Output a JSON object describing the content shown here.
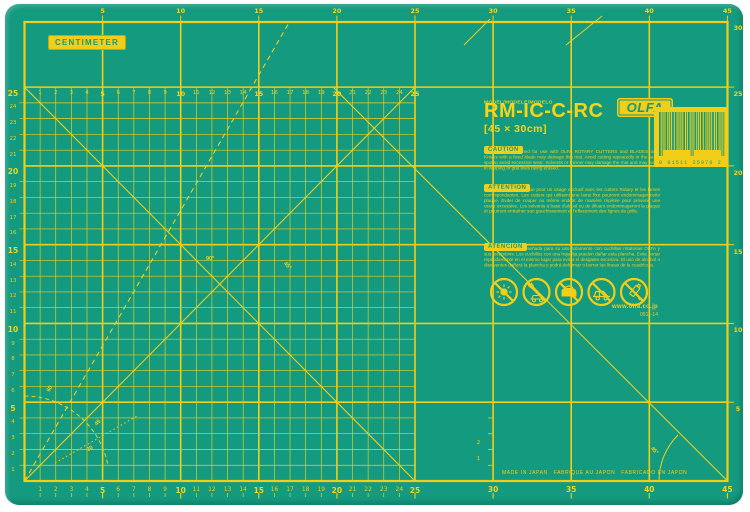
{
  "colors": {
    "mat_green": "#149A7F",
    "grid_yellow": "#F2CE18",
    "bright_yellow": "#F7D516",
    "page_white": "#FFFFFF"
  },
  "unit_tag": "CENTIMETER",
  "rulers": {
    "top": [
      "5",
      "10",
      "15",
      "20",
      "25",
      "30",
      "35",
      "40",
      "45"
    ],
    "grid_top": [
      "1",
      "2",
      "3",
      "4",
      "5",
      "6",
      "7",
      "8",
      "9",
      "10",
      "11",
      "12",
      "13",
      "14",
      "15",
      "16",
      "17",
      "18",
      "19",
      "20",
      "21",
      "22",
      "23",
      "24",
      "25"
    ],
    "bottom": [
      "1",
      "2",
      "3",
      "4",
      "5",
      "6",
      "7",
      "8",
      "9",
      "10",
      "11",
      "12",
      "13",
      "14",
      "15",
      "16",
      "17",
      "18",
      "19",
      "20",
      "21",
      "22",
      "23",
      "24",
      "25"
    ],
    "bottom_coarse": [
      "30",
      "35",
      "40",
      "45"
    ],
    "left": [
      "1",
      "2",
      "3",
      "4",
      "5",
      "6",
      "7",
      "8",
      "9",
      "10",
      "11",
      "12",
      "13",
      "14",
      "15",
      "16",
      "17",
      "18",
      "19",
      "20",
      "21",
      "22",
      "23",
      "24",
      "25"
    ],
    "right": [
      "30",
      "25",
      "20",
      "15",
      "10",
      "5"
    ],
    "mini": [
      "2",
      "1"
    ]
  },
  "angle_labels": {
    "a60": "60",
    "a45": "45",
    "a30": "30",
    "a90": "90°",
    "mid45": "45°",
    "br45": "45°"
  },
  "label": {
    "model_caption": "MODEL/MODELE/MODELO",
    "model": "RM-IC-C-RC",
    "size": "[45 × 30cm]",
    "brand": "OLFA",
    "brand_reg": "®",
    "sections": [
      {
        "heading": "CAUTION",
        "body": "This mat is designed for use with OLFA ROTARY CUTTERS and BLADES only. Knives with a fixed blade may damage this mat. Avoid cutting repeatedly in the same spot to avoid excessive wear. Solvents or thinner may damage the mat and may result in warping or grid lines being erased."
      },
      {
        "heading": "ATTENTION",
        "body": "Cette plaque est conçue pour un usage exclusif avec les cutters Rotary et les lames correspondantes. Les cutters qui utilisent une lame fixe pourront endommager cette plaque. Eviter de couper au même endroit de manière répétée pour prévenir une usure excessive. Les solvants à base d'alcool ou de diluant endommageront la plaque et pourront entraîner son gauchissement et l'effacement des lignes de grille."
      },
      {
        "heading": "ATENCIÓN",
        "body": "Esta plancha está diseñada para su uso solamente con cuchillas rotatorias OLFA y sus recambios. Los cuchillos con una hoja fija pueden dañar esta plancha. Evite cortar repetidamente en el mismo lugar para evitar el desgaste excesivo. El uso de alcohol o disolventes dañará la plancha y podrá deformar o borrar las líneas de la cuadrícula."
      }
    ],
    "website": "www.olfa.co.jp",
    "code": "0511-14"
  },
  "barcode": {
    "digits": "0 91511 25076 2"
  },
  "footer": "MADE IN JAPAN   FABRIQUE AU JAPON   FABRICADO EN JAPON",
  "icons": {
    "items": [
      "no-sunlight",
      "no-hot-car",
      "no-iron",
      "no-car-window",
      "no-solvent"
    ]
  }
}
